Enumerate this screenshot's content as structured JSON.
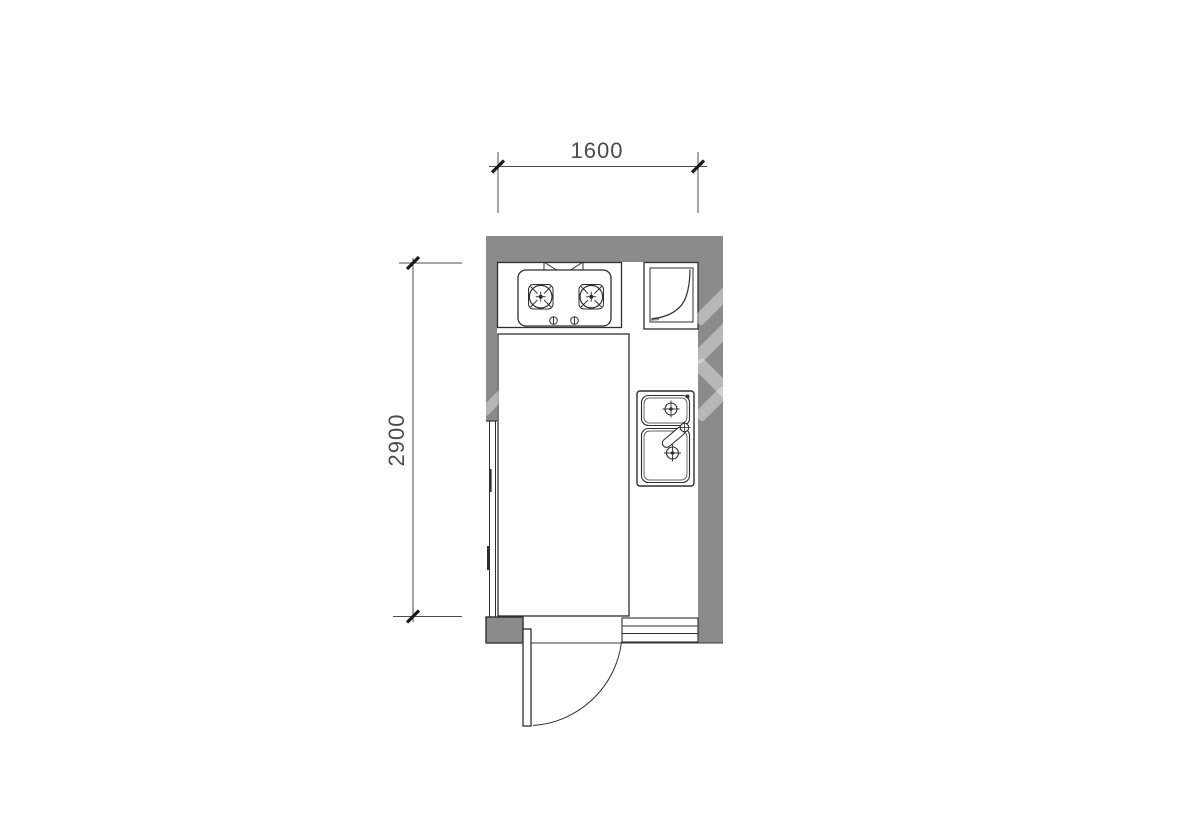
{
  "drawing": {
    "type": "kitchen-floor-plan",
    "dimensions": {
      "width": {
        "label": "1600"
      },
      "depth": {
        "label": "2900"
      }
    },
    "fixtures": [
      {
        "name": "range-hood-icon"
      },
      {
        "name": "gas-cooktop-icon"
      },
      {
        "name": "corner-appliance-icon"
      },
      {
        "name": "double-bowl-sink-icon"
      },
      {
        "name": "window"
      },
      {
        "name": "swing-door"
      },
      {
        "name": "threshold-step"
      }
    ],
    "colors": {
      "wall": "#8b8b8b",
      "line": "#2f2f2f",
      "dimension": "#4c4c4c",
      "background": "#ffffff"
    }
  }
}
